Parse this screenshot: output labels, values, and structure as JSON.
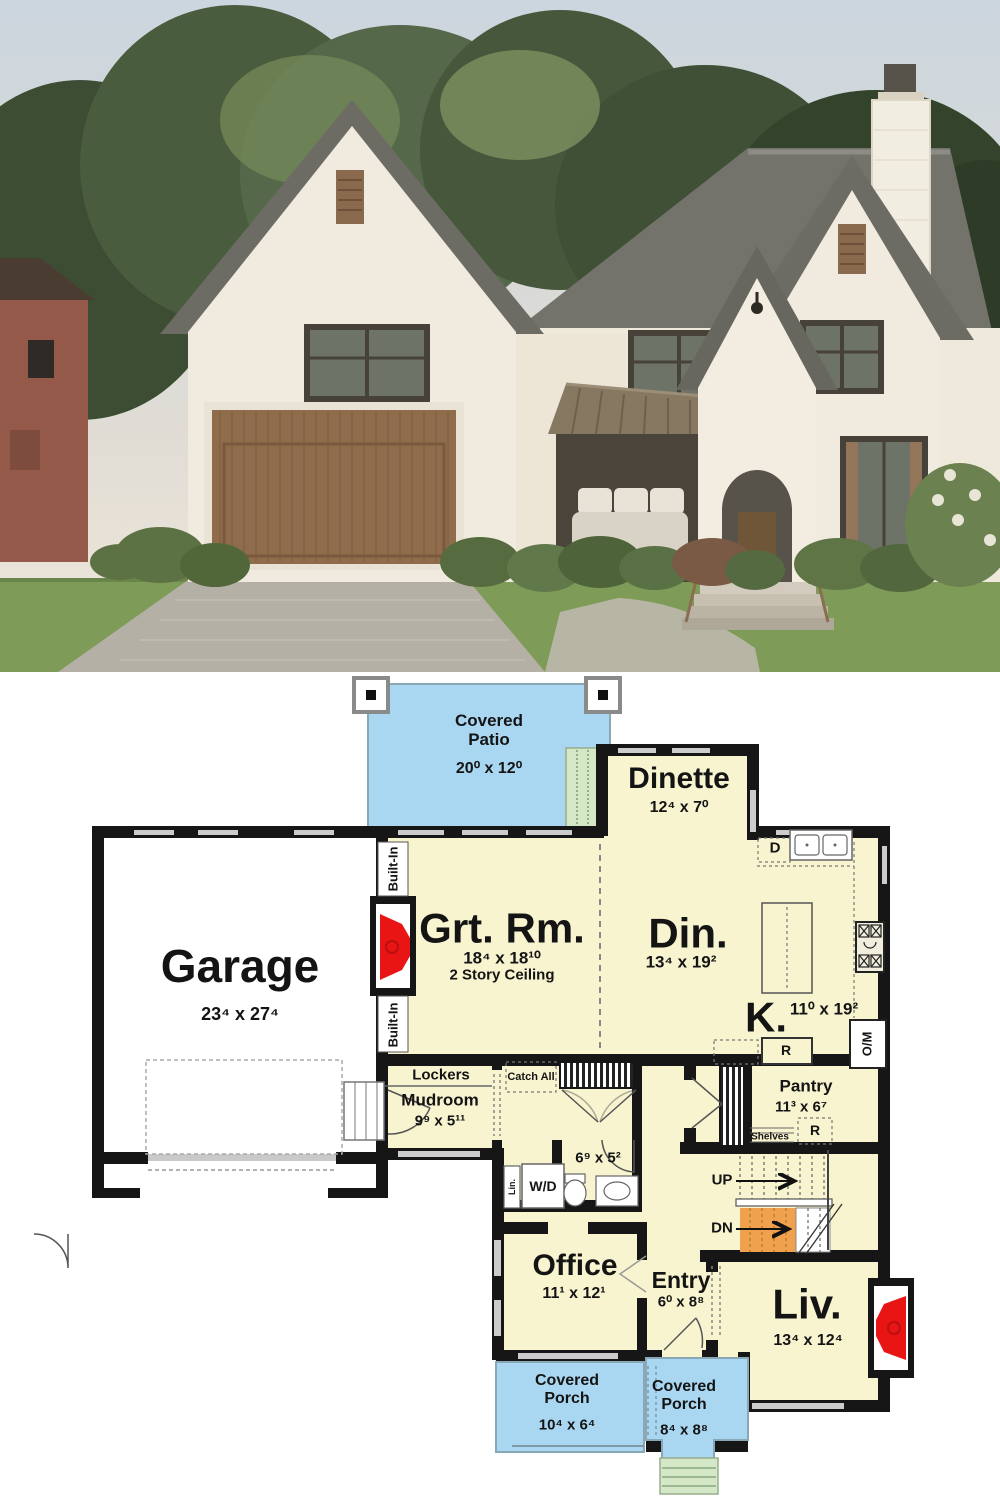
{
  "photo": {
    "subject": "house-exterior"
  },
  "plan": {
    "rooms": {
      "covered_patio": {
        "name": "Covered Patio",
        "dims": "20⁰ x 12⁰"
      },
      "dinette": {
        "name": "Dinette",
        "dims": "12⁴ x 7⁰"
      },
      "great_room": {
        "name": "Grt. Rm.",
        "dims": "18⁴ x 18¹⁰",
        "note": "2 Story Ceiling"
      },
      "dining": {
        "name": "Din.",
        "dims": "13⁴ x 19²"
      },
      "kitchen": {
        "name": "K.",
        "dims": "11⁰ x 19²"
      },
      "garage": {
        "name": "Garage",
        "dims": "23⁴ x 27⁴"
      },
      "mudroom": {
        "name": "Mudroom",
        "dims": "9⁹ x 5¹¹",
        "lockers": "Lockers"
      },
      "pantry": {
        "name": "Pantry",
        "dims": "11³ x 6⁷",
        "shelves": "Shelves"
      },
      "bath": {
        "dims": "6⁹ x 5²"
      },
      "office": {
        "name": "Office",
        "dims": "11¹ x 12¹"
      },
      "entry": {
        "name": "Entry",
        "dims": "6⁰ x 8⁸"
      },
      "living": {
        "name": "Liv.",
        "dims": "13⁴ x 12⁴"
      },
      "porch_left": {
        "name": "Covered Porch",
        "dims": "10⁴ x 6⁴"
      },
      "porch_right": {
        "name": "Covered Porch",
        "dims": "8⁴ x 8⁸"
      }
    },
    "annotations": {
      "built_in_top": "Built-In",
      "built_in_bottom": "Built-In",
      "catch_all": "Catch All",
      "up": "UP",
      "dn": "DN",
      "dishwasher": "D",
      "fridge_kitchen": "R",
      "fridge_pantry": "R",
      "oven_microwave": "O/M",
      "washer_dryer": "W/D",
      "linen": "Lin."
    },
    "colors": {
      "room_fill": "#F8F4D0",
      "patio_porch": "#A9D7F1",
      "steps_green": "#D4E8C8",
      "stairs_dn": "#F0A14D",
      "fireplace_red": "#E91515",
      "walls": "#161616"
    }
  }
}
